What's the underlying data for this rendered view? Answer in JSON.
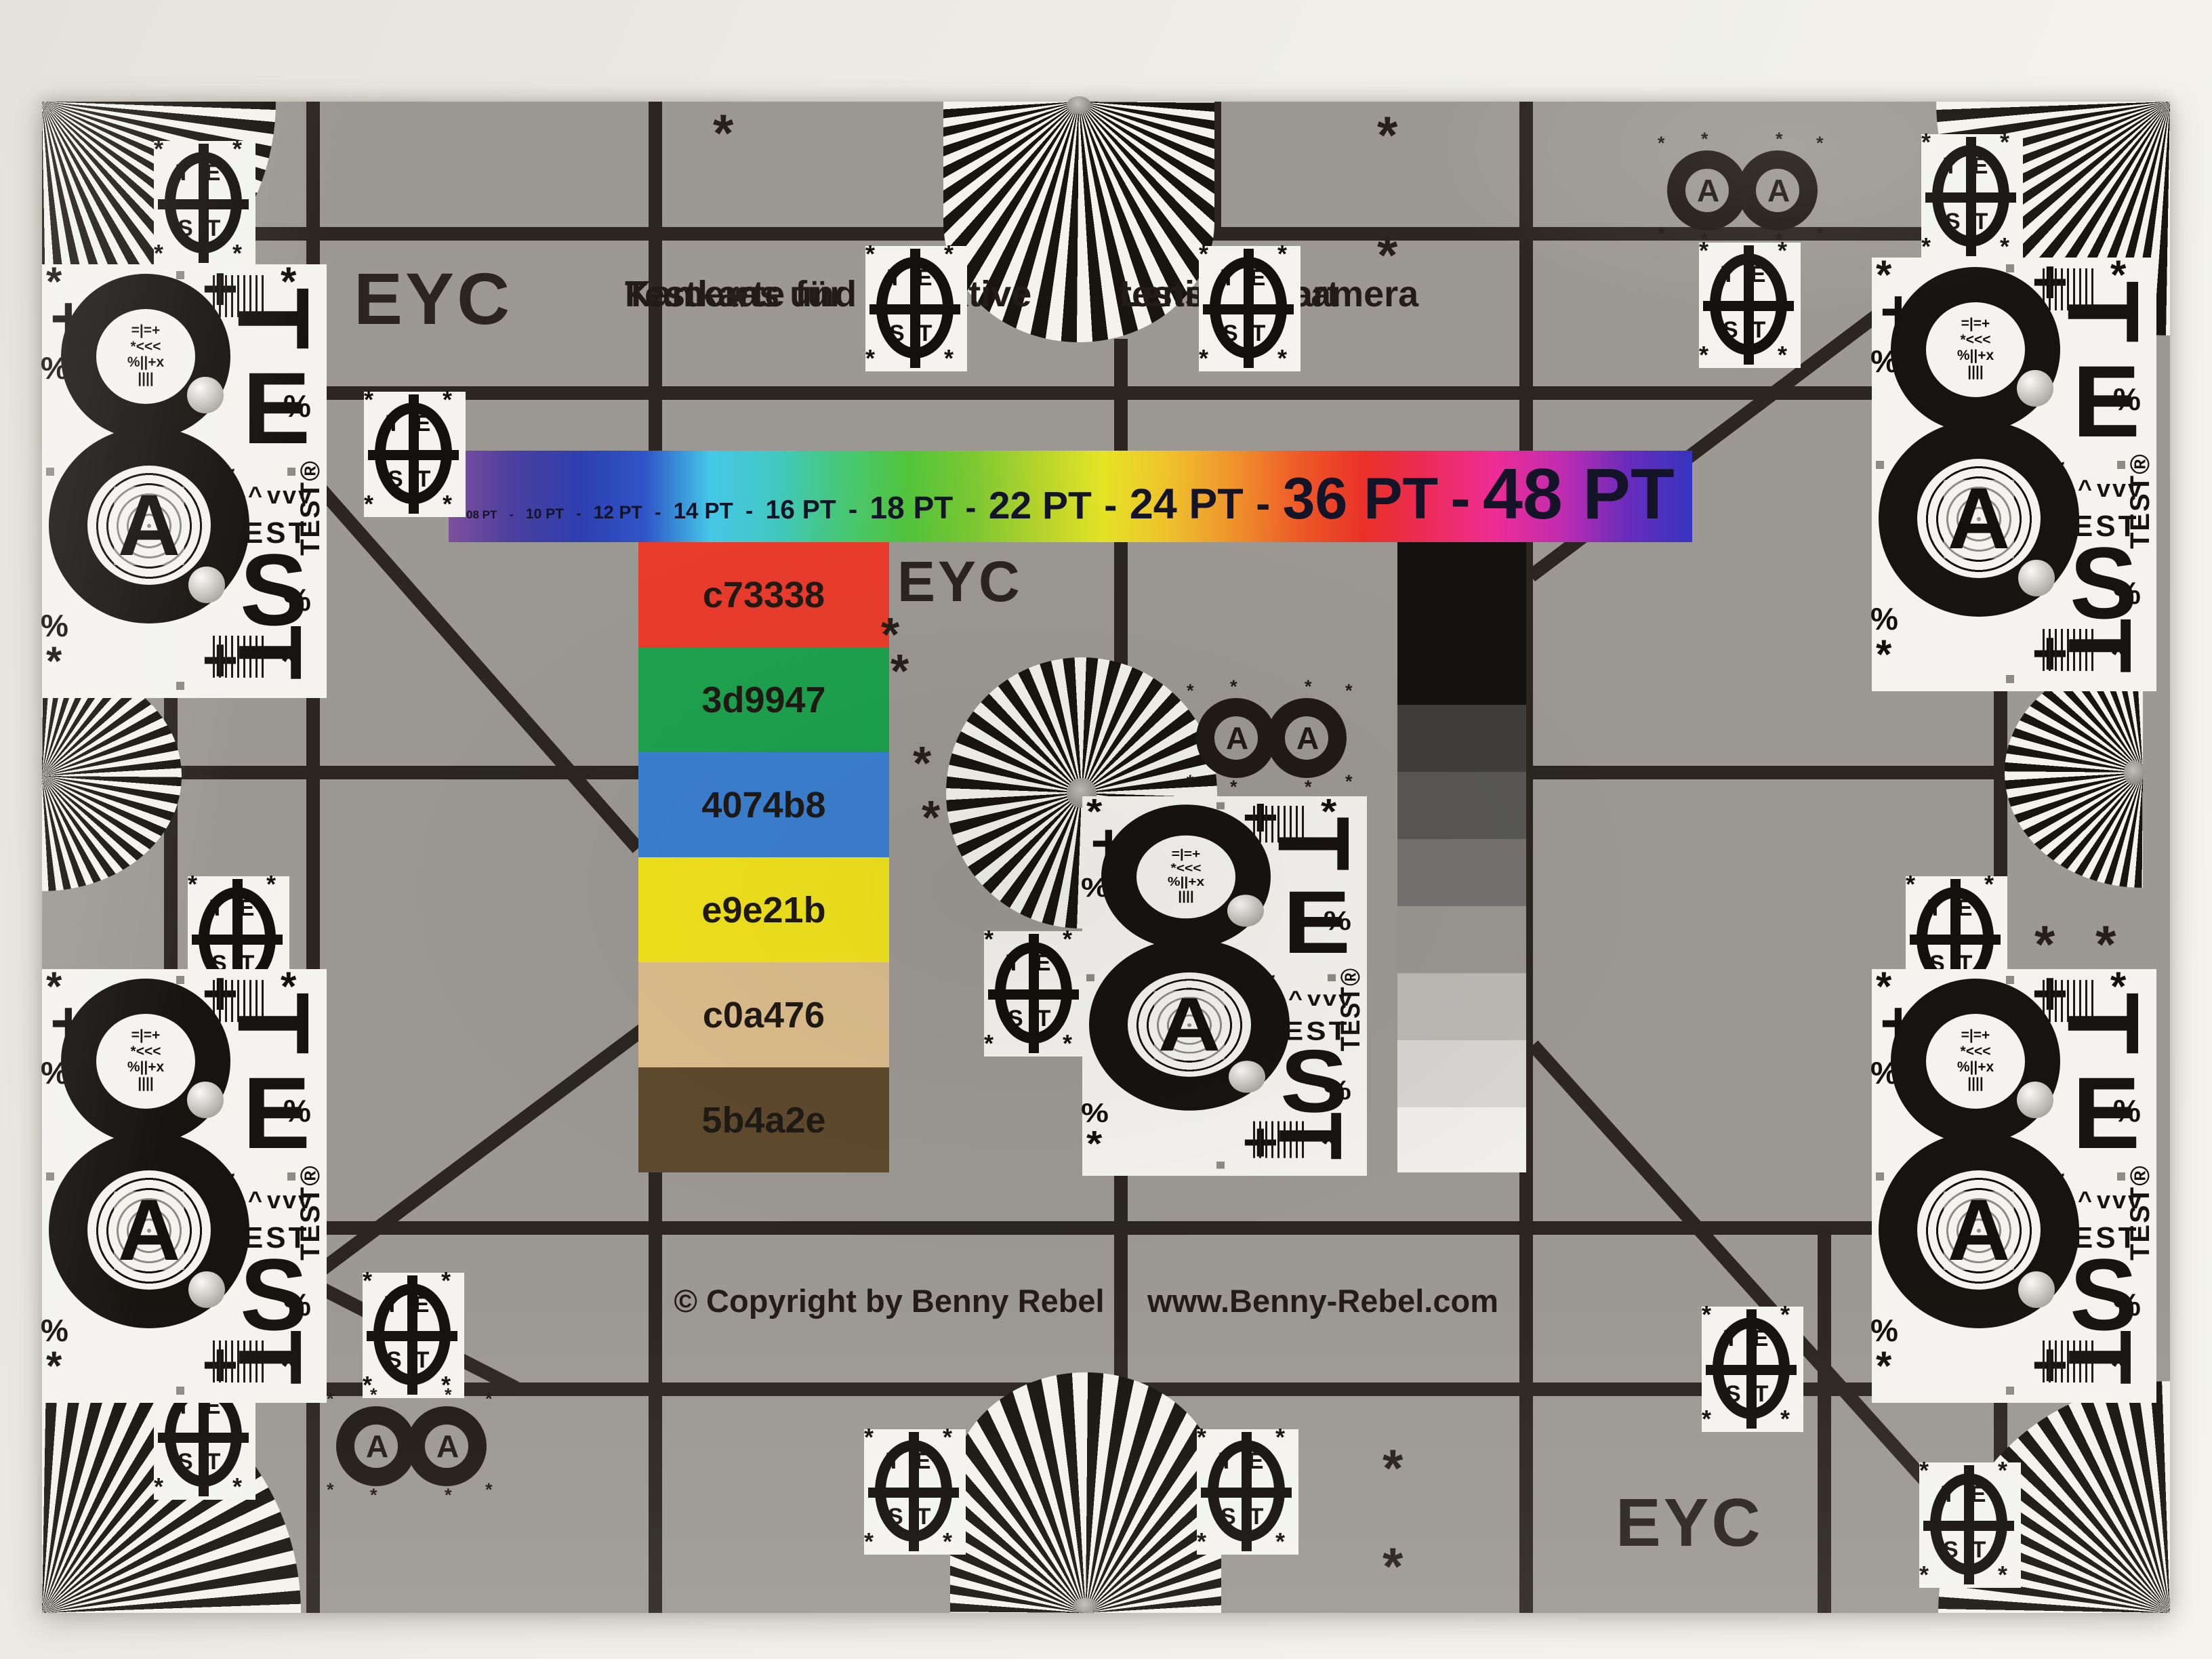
{
  "chart": {
    "eyc_label": "EYC",
    "title_de_line1": "Testkarte für",
    "title_de_line2": "Kameras und Objektive",
    "title_en_line1": "Lens and camera",
    "title_en_line2": "testing chart",
    "copyright": "© Copyright by Benny Rebel",
    "website": "www.Benny-Rebel.com",
    "font_size_bar": {
      "labels": [
        "08 PT",
        "10 PT",
        "12 PT",
        "14 PT",
        "16 PT",
        "18 PT",
        "22 PT",
        "24 PT",
        "36 PT",
        "48 PT"
      ],
      "separator": "-",
      "gradient": [
        "#7e4f9e",
        "#4a3f9f",
        "#2e3fb0",
        "#2f55c8",
        "#45c8e8",
        "#41c9c0",
        "#47c878",
        "#52c43c",
        "#7cc832",
        "#b5d42c",
        "#e6e426",
        "#f0c22c",
        "#f0922c",
        "#ee5a28",
        "#ea3028",
        "#ec2c5c",
        "#ee2c96",
        "#c02cb0",
        "#6a2cbc",
        "#3534c0"
      ]
    },
    "color_patches": [
      {
        "label": "c73338",
        "color": "#e93c2c"
      },
      {
        "label": "3d9947",
        "color": "#1ea24e"
      },
      {
        "label": "4074b8",
        "color": "#3b80d1"
      },
      {
        "label": "e9e21b",
        "color": "#f1e31d"
      },
      {
        "label": "c0a476",
        "color": "#dcbd8d"
      },
      {
        "label": "5b4a2e",
        "color": "#604a2e"
      }
    ],
    "grayscale_steps": [
      "#403f3d",
      "#585755",
      "#747170",
      "#999591",
      "#bcb9b5",
      "#d8d6d2",
      "#f0efeb"
    ],
    "glyphs": {
      "asterisk": "*",
      "percent": "%",
      "plus": "+",
      "eight": "8",
      "letter_a": "A",
      "letter_t": "T",
      "letter_e": "E",
      "letter_s": "S",
      "test_word": "TEST",
      "test_registered": "TEST®",
      "te": "TE",
      "st": "ST",
      "arrows_left": "<<<",
      "arrows_up": "^^^",
      "arrows_down": "vvv",
      "micro_row1": "=|=+",
      "micro_row2": "*<<<",
      "micro_row3": "%||+x",
      "micro_row4": "||||"
    },
    "colors": {
      "chart_gray": "#9c9893",
      "grid_line": "#2b2622",
      "panel_white": "#f4f3ef",
      "page_background": "#efeee8"
    }
  }
}
